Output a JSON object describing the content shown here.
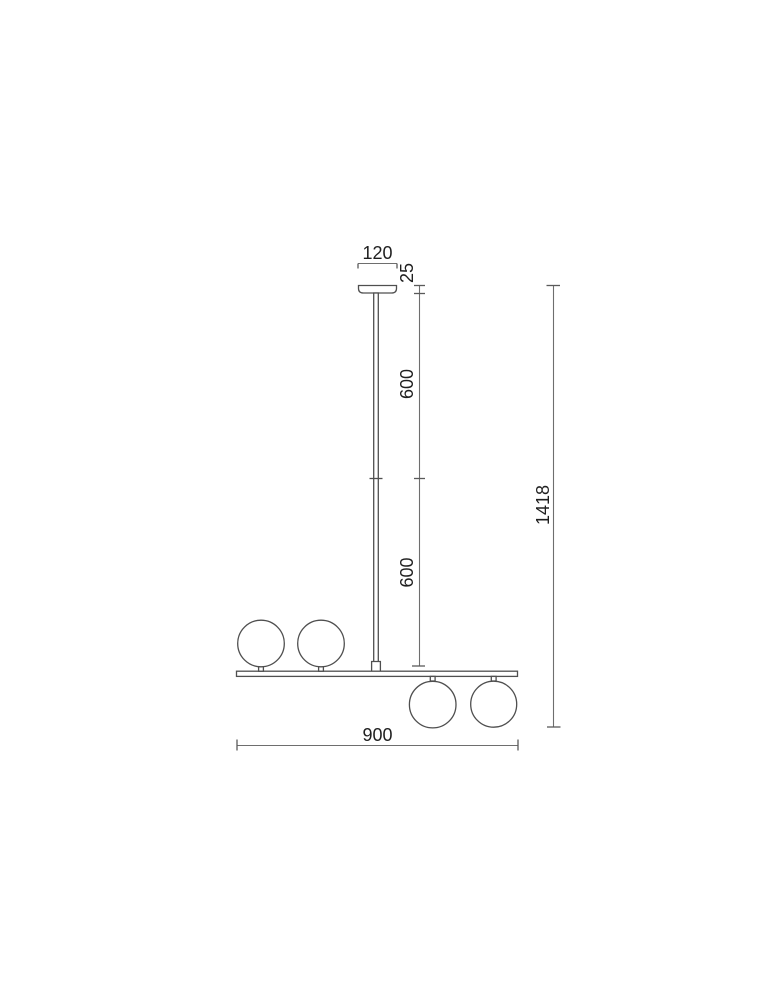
{
  "drawing": {
    "type": "technical-dimension-drawing",
    "subject": "linear pendant lamp with four glass globes, front elevation with dimensions in mm",
    "colors": {
      "background": "#ffffff",
      "fixture_line": "#4f4f4f",
      "dimension_line": "#6e6e6e",
      "text": "#1f1f1f"
    },
    "labels": {
      "canopy_width": "120",
      "canopy_height": "25",
      "upper_rod_length": "600",
      "lower_rod_length": "600",
      "total_height": "1418",
      "bar_length": "900"
    }
  }
}
